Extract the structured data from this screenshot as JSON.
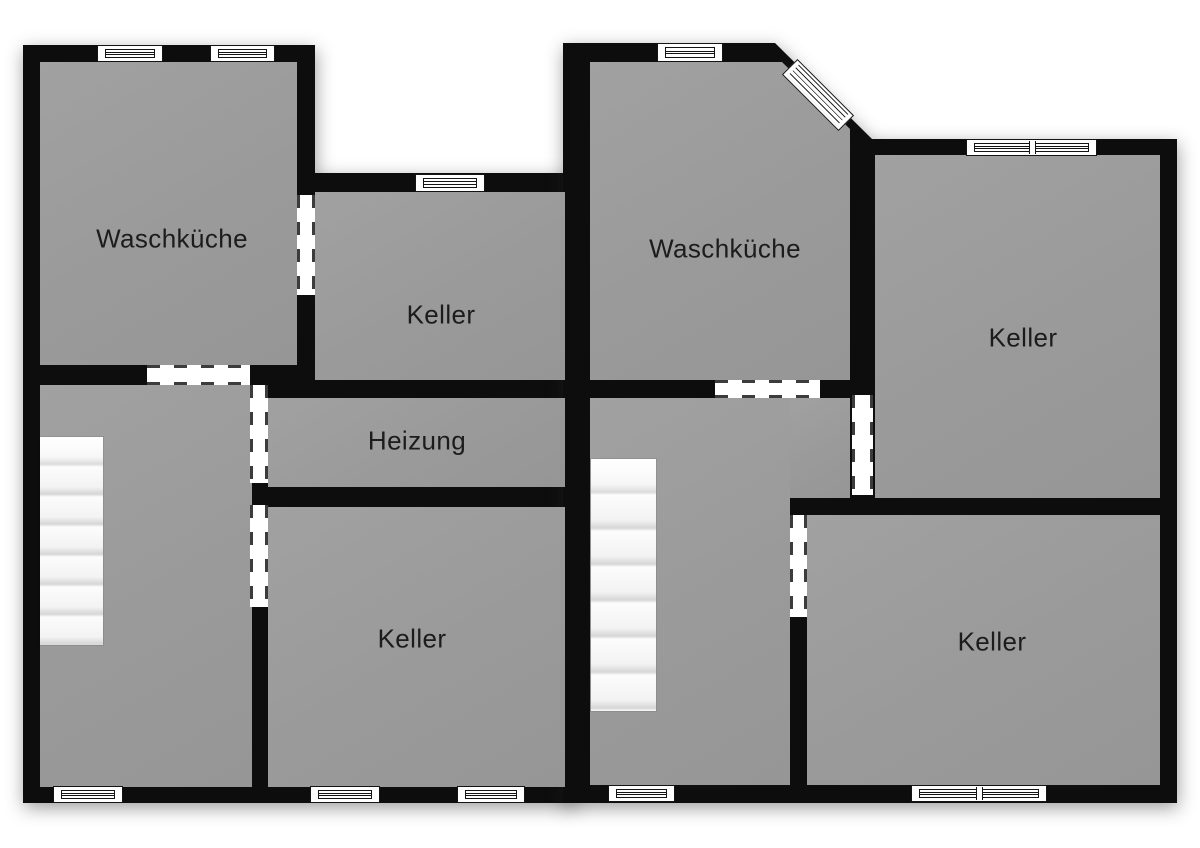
{
  "plan": {
    "type": "basement floor plan",
    "language": "de"
  },
  "palette": {
    "wall": "#0d0d0d",
    "floor": "#9c9c9c",
    "background": "#ffffff",
    "stair_tread": "#f3f3f3",
    "text": "#1c1c1c"
  },
  "rooms": [
    {
      "id": "waschkueche-left",
      "label": "Waschküche"
    },
    {
      "id": "keller-top-middle",
      "label": "Keller"
    },
    {
      "id": "heizung",
      "label": "Heizung"
    },
    {
      "id": "keller-bottom-left",
      "label": "Keller"
    },
    {
      "id": "waschkueche-right",
      "label": "Waschküche"
    },
    {
      "id": "keller-top-right",
      "label": "Keller"
    },
    {
      "id": "keller-bottom-right",
      "label": "Keller"
    }
  ],
  "stairs": [
    {
      "id": "stairs-left",
      "treads": 7
    },
    {
      "id": "stairs-right",
      "treads": 7
    }
  ],
  "openings": {
    "windows": 11,
    "doors": 7
  }
}
